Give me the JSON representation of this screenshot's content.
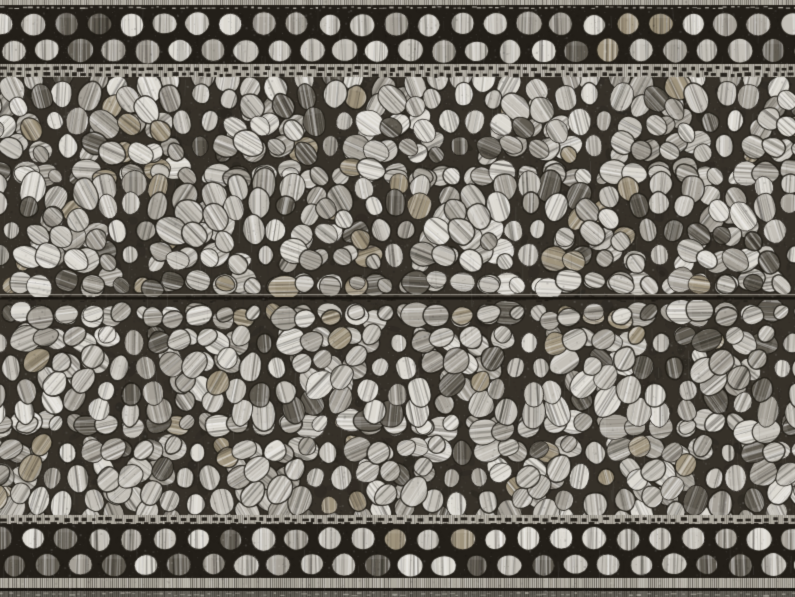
{
  "scene": {
    "type": "texture-photo",
    "subject": "Cobblestone pavement texture sheet",
    "description": "Scanned grayscale texture of a model cobblestone road: fan-pattern granite cobbles between straight border courses of rectangular setts, split across the middle by a horizontal sheet seam, with strong vertical striations and photocopy grain"
  },
  "canvas": {
    "width": 795,
    "height": 597
  },
  "palette": {
    "mortar": "#332f28",
    "mortar_deep": "#1f1c17",
    "stone_bright": "#e3e1da",
    "stone_light": "#c9c6be",
    "stone_mid": "#a8a49b",
    "stone_dark": "#5f5b52",
    "stone_warm": "#a1967f",
    "joint_dark": "#23201b",
    "strip_light": "#b2aea4",
    "seam_line": "#15120e"
  },
  "layout": {
    "top_edge": {
      "y0": 0,
      "y1": 11,
      "light_split": 5
    },
    "top_setts": {
      "y0": 11,
      "y1": 64,
      "rows": 2,
      "pitch": 33,
      "stone_w": 26,
      "stone_h": 25,
      "dark_chance": 0.08
    },
    "top_dots": {
      "y0": 64,
      "y1": 77,
      "line_ys": [
        67,
        73
      ]
    },
    "fan_field_upper": {
      "y0": 77,
      "y1": 296,
      "center_rows": [
        187,
        296
      ],
      "direction": "up"
    },
    "seam": {
      "light_y": 294,
      "dark_y": 297,
      "dark_h": 2.5
    },
    "fan_field_lower": {
      "y0": 301,
      "y1": 515,
      "center_rows": [
        412,
        302
      ],
      "direction": "down"
    },
    "bottom_dots": {
      "y0": 515,
      "y1": 526,
      "line_ys": [
        518,
        523
      ]
    },
    "bottom_setts": {
      "y0": 526,
      "y1": 578,
      "rows": 2,
      "pitch": 33,
      "stone_w": 26,
      "stone_h": 24,
      "dark_chance": 0.22
    },
    "bottom_edge": {
      "y0": 578,
      "y1": 597,
      "dark_line_y": 588
    }
  },
  "fan": {
    "width": 132,
    "radius": 112,
    "ring_step": 26,
    "min_radius": 15,
    "stone_spacing": 27
  },
  "noise": {
    "grain_specks": 15000,
    "scratches": 700,
    "seed": 20240917
  }
}
